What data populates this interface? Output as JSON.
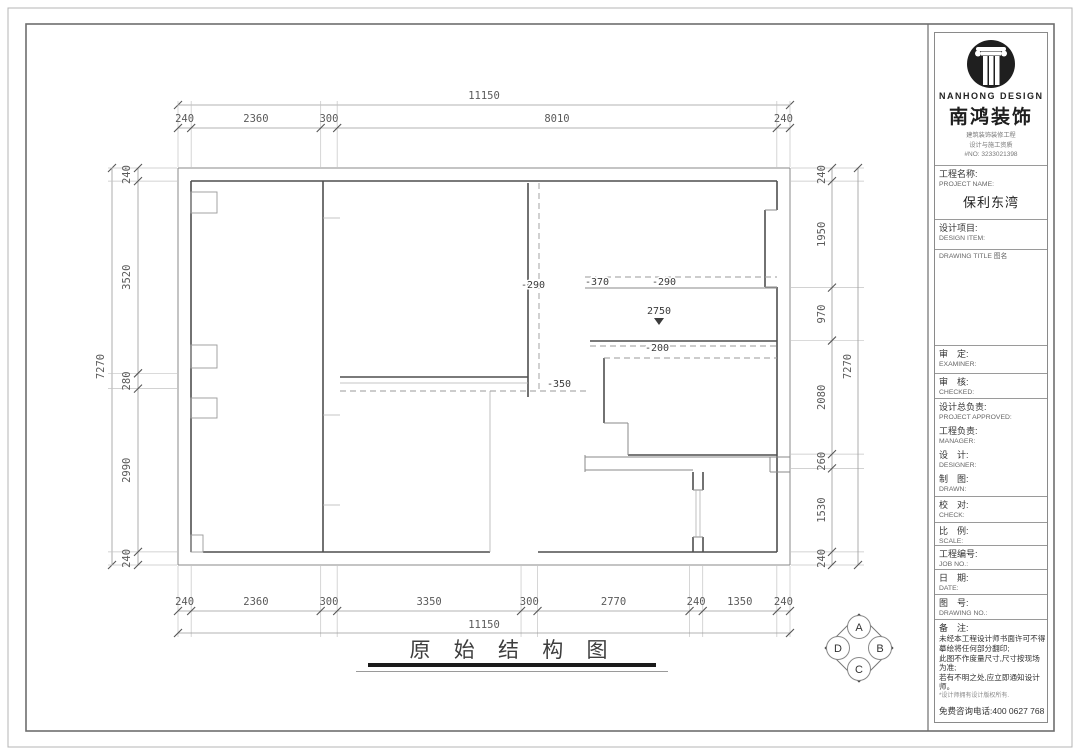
{
  "plan": {
    "title": "原 始 结 构 图",
    "dims": {
      "top": {
        "total": "11150",
        "segments": [
          "240",
          "2360",
          "300",
          "8010",
          "240"
        ]
      },
      "bottom": {
        "total": "11150",
        "segments": [
          "240",
          "2360",
          "300",
          "3350",
          "300",
          "2770",
          "240",
          "1350",
          "240"
        ]
      },
      "left": {
        "total": "7270",
        "segments": [
          "240",
          "3520",
          "280",
          "2990",
          "240"
        ]
      },
      "right": {
        "total": "7270",
        "segments": [
          "240",
          "1950",
          "970",
          "2080",
          "260",
          "1530",
          "240"
        ]
      }
    },
    "annotations": [
      {
        "text": "-290",
        "x": 533,
        "y": 288
      },
      {
        "text": "-370",
        "x": 597,
        "y": 285
      },
      {
        "text": "-290",
        "x": 664,
        "y": 285
      },
      {
        "text": "2750",
        "x": 659,
        "y": 314,
        "marker": "down-triangle"
      },
      {
        "text": "-200",
        "x": 657,
        "y": 351
      },
      {
        "text": "-350",
        "x": 559,
        "y": 387
      }
    ]
  },
  "compass": {
    "top": "A",
    "right": "B",
    "bottom": "C",
    "left": "D"
  },
  "titleblock": {
    "logo": {
      "en": "NANHONG DESIGN",
      "cn": "南鸿装饰",
      "sub1": "建筑装饰装修工程",
      "sub2": "设计与施工资质",
      "no": "#NO: 3233021398"
    },
    "project": {
      "cn": "工程名称:",
      "en": "PROJECT NAME:",
      "value": "保利东湾"
    },
    "design_item": {
      "cn": "设计项目:",
      "en": "DESIGN ITEM:"
    },
    "drawing_title_label": "DRAWING TITLE 图名",
    "fields": [
      {
        "cn": "审　定:",
        "en": "EXAMINER:"
      },
      {
        "cn": "审　核:",
        "en": "CHECKED:"
      },
      {
        "cn": "设计总负责:",
        "en": "PROJECT APPROVED:"
      },
      {
        "cn": "工程负责:",
        "en": "MANAGER:"
      },
      {
        "cn": "设　计:",
        "en": "DESIGNER:"
      },
      {
        "cn": "制　图:",
        "en": "DRAWN:"
      },
      {
        "cn": "校　对:",
        "en": "CHECK:"
      },
      {
        "cn": "比　例:",
        "en": "SCALE:"
      },
      {
        "cn": "工程编号:",
        "en": "JOB NO.:"
      },
      {
        "cn": "日　期:",
        "en": "DATE:"
      },
      {
        "cn": "图　号:",
        "en": "DRAWING NO.:"
      }
    ],
    "remark": {
      "title": "备　注:",
      "lines": [
        "未经本工程设计师书面许可不得",
        "摹绘将任何部分翻印;",
        "此图不作度量尺寸,尺寸按现场",
        "为准;",
        "若有不明之处,应立即通知设计",
        "师。"
      ],
      "small": "*设计师拥有设计版权所有.",
      "hotline": "免费咨询电话:400 0627 768"
    }
  }
}
